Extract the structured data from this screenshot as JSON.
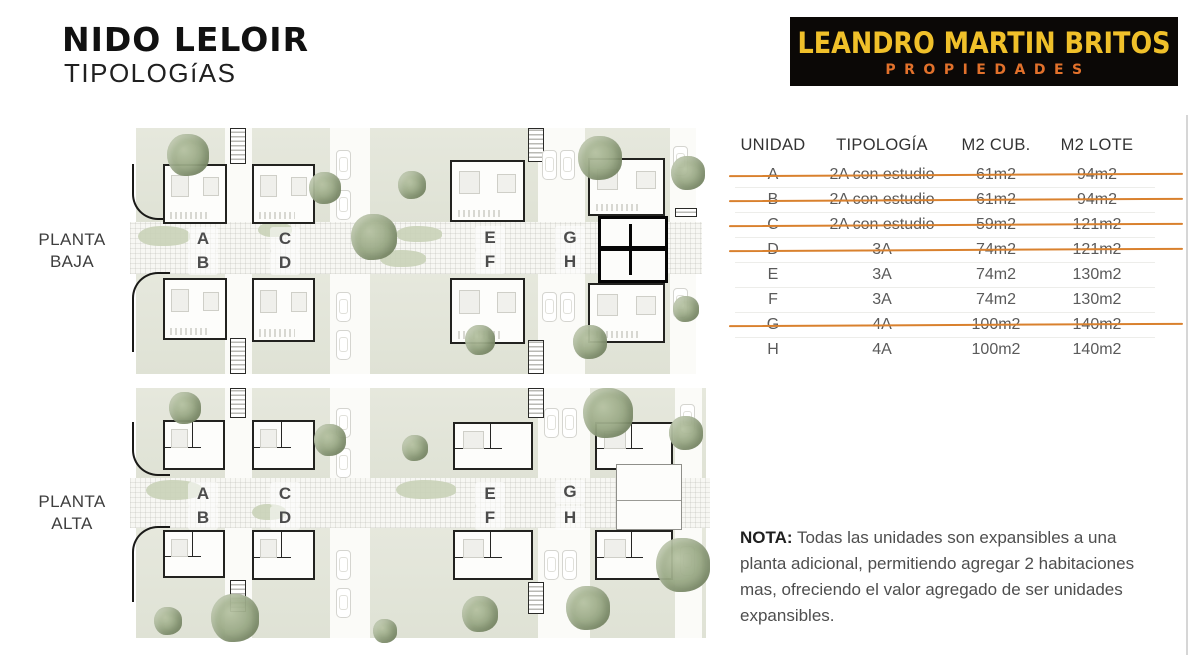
{
  "header": {
    "title": "NIDO LELOIR",
    "subtitle": "TIPOLOGíAS"
  },
  "logo": {
    "name": "LEANDRO MARTIN BRITOS",
    "tagline": "PROPIEDADES"
  },
  "plans": [
    {
      "label_line1": "PLANTA",
      "label_line2": "BAJA",
      "units": [
        "A",
        "B",
        "C",
        "D",
        "E",
        "F",
        "G",
        "H"
      ]
    },
    {
      "label_line1": "PLANTA",
      "label_line2": "ALTA",
      "units": [
        "A",
        "B",
        "C",
        "D",
        "E",
        "F",
        "G",
        "H"
      ]
    }
  ],
  "table": {
    "headers": [
      "UNIDAD",
      "TIPOLOGÍA",
      "M2 CUB.",
      "M2 LOTE"
    ],
    "rows": [
      {
        "unidad": "A",
        "tipologia": "2A con estudio",
        "m2_cub": "61m2",
        "m2_lote": "94m2",
        "sold": true
      },
      {
        "unidad": "B",
        "tipologia": "2A con estudio",
        "m2_cub": "61m2",
        "m2_lote": "94m2",
        "sold": true
      },
      {
        "unidad": "C",
        "tipologia": "2A con estudio",
        "m2_cub": "59m2",
        "m2_lote": "121m2",
        "sold": true
      },
      {
        "unidad": "D",
        "tipologia": "3A",
        "m2_cub": "74m2",
        "m2_lote": "121m2",
        "sold": true
      },
      {
        "unidad": "E",
        "tipologia": "3A",
        "m2_cub": "74m2",
        "m2_lote": "130m2",
        "sold": false
      },
      {
        "unidad": "F",
        "tipologia": "3A",
        "m2_cub": "74m2",
        "m2_lote": "130m2",
        "sold": false
      },
      {
        "unidad": "G",
        "tipologia": "4A",
        "m2_cub": "100m2",
        "m2_lote": "140m2",
        "sold": true
      },
      {
        "unidad": "H",
        "tipologia": "4A",
        "m2_cub": "100m2",
        "m2_lote": "140m2",
        "sold": false
      }
    ]
  },
  "note": {
    "label": "NOTA:",
    "text": " Todas las unidades son expansibles a una planta adicional, permitiendo agregar 2 habitaciones mas, ofreciendo el valor agregado de ser unidades expansibles."
  },
  "colors": {
    "strike": "#d9812e",
    "logo_yellow": "#f0c02a",
    "logo_orange": "#e2712b",
    "logo_bg": "#0b0806"
  }
}
